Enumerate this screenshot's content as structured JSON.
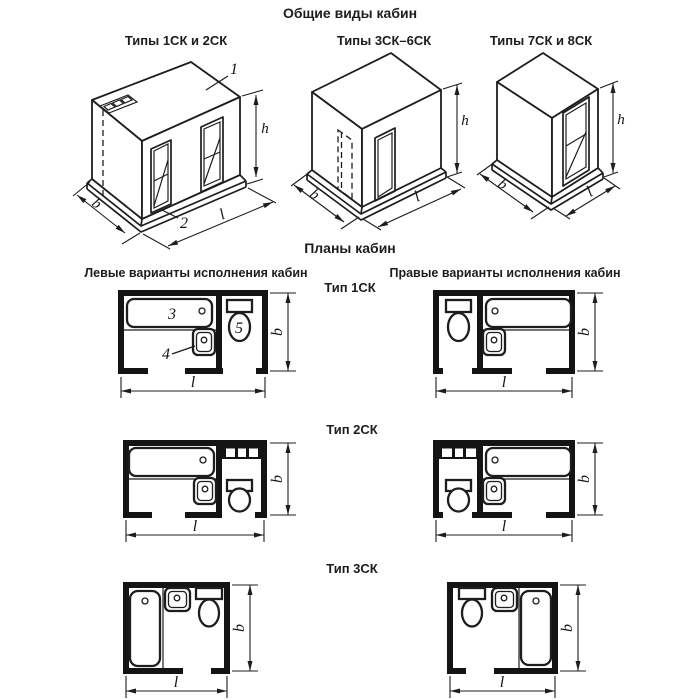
{
  "figure": {
    "title": "Общие виды кабин",
    "plans_title": "Планы кабин",
    "left_variants_header": "Левые варианты исполнения кабин",
    "right_variants_header": "Правые варианты исполнения кабин"
  },
  "general_views": [
    {
      "label": "Типы 1СК и 2СК"
    },
    {
      "label": "Типы 3СК–6СК"
    },
    {
      "label": "Типы 7СК и 8СК"
    }
  ],
  "plan_rows": [
    {
      "label": "Тип 1СК"
    },
    {
      "label": "Тип 2СК"
    },
    {
      "label": "Тип 3СК"
    }
  ],
  "callouts": {
    "roof_panel": "1",
    "floor_panel": "2",
    "bath": "3",
    "washbasin": "4",
    "toilet": "5"
  },
  "dims": {
    "height": "h",
    "depth": "b",
    "length": "l"
  },
  "colors": {
    "ink": "#1d1d1d",
    "paper": "#ffffff"
  }
}
